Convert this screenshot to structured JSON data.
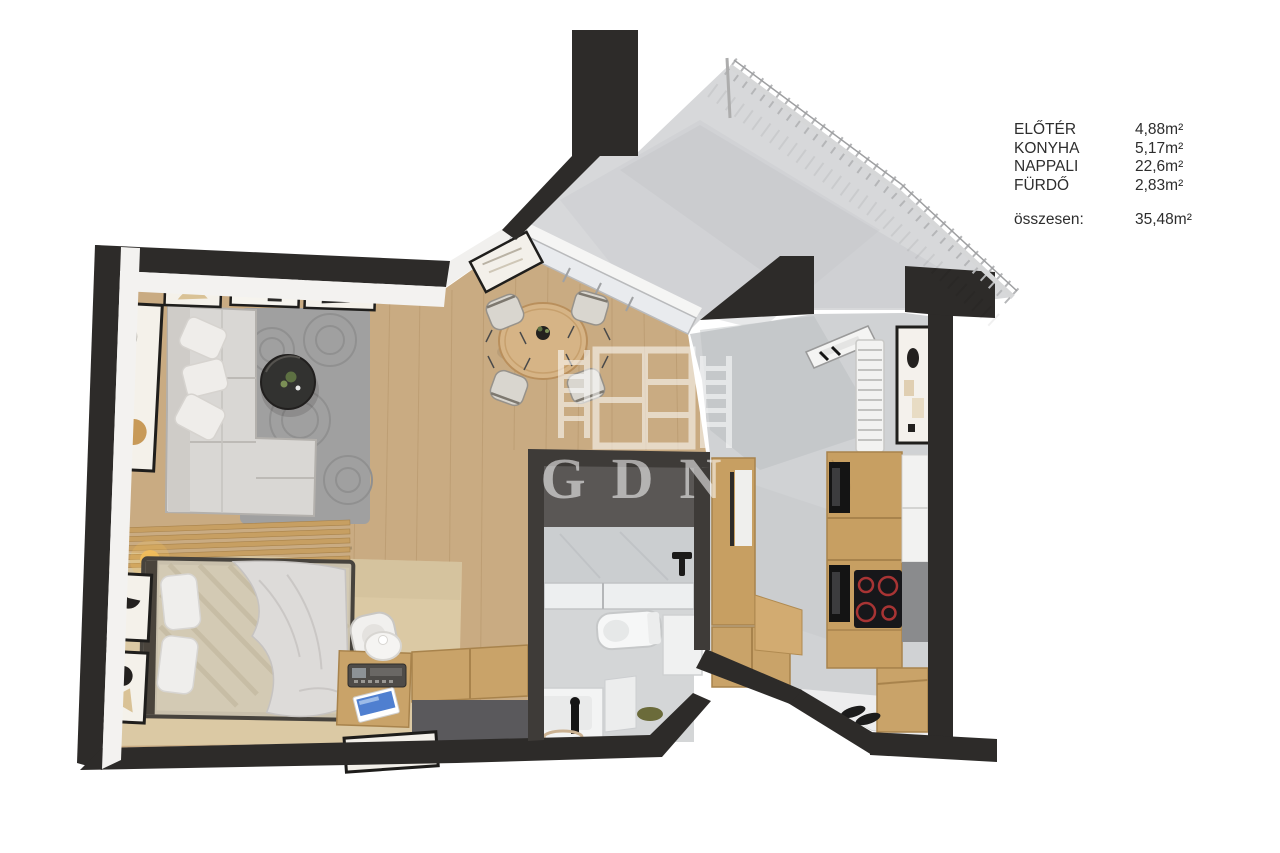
{
  "legend": {
    "rows": [
      {
        "label": "ELŐTÉR",
        "value": "4,88m²"
      },
      {
        "label": "KONYHA",
        "value": "5,17m²"
      },
      {
        "label": "NAPPALI",
        "value": "22,6m²"
      },
      {
        "label": "FÜRDŐ",
        "value": "2,83m²"
      }
    ],
    "total": {
      "label": "összesen:",
      "value": "35,48m²"
    }
  },
  "watermark": {
    "text": "GDN"
  },
  "palette": {
    "wall": "#2d2b29",
    "bath_wall": "#3e3b38",
    "wood_floor": "#c9ab82",
    "carpet": "#dbc9a4",
    "marble": "#d0d2d4",
    "balcony": "#d7d8da",
    "cabinet_wood": "#c79f62",
    "rug": "#a0a0a0",
    "cooktop_ring": "#a83434",
    "laptop_screen": "#4f7fd0"
  }
}
